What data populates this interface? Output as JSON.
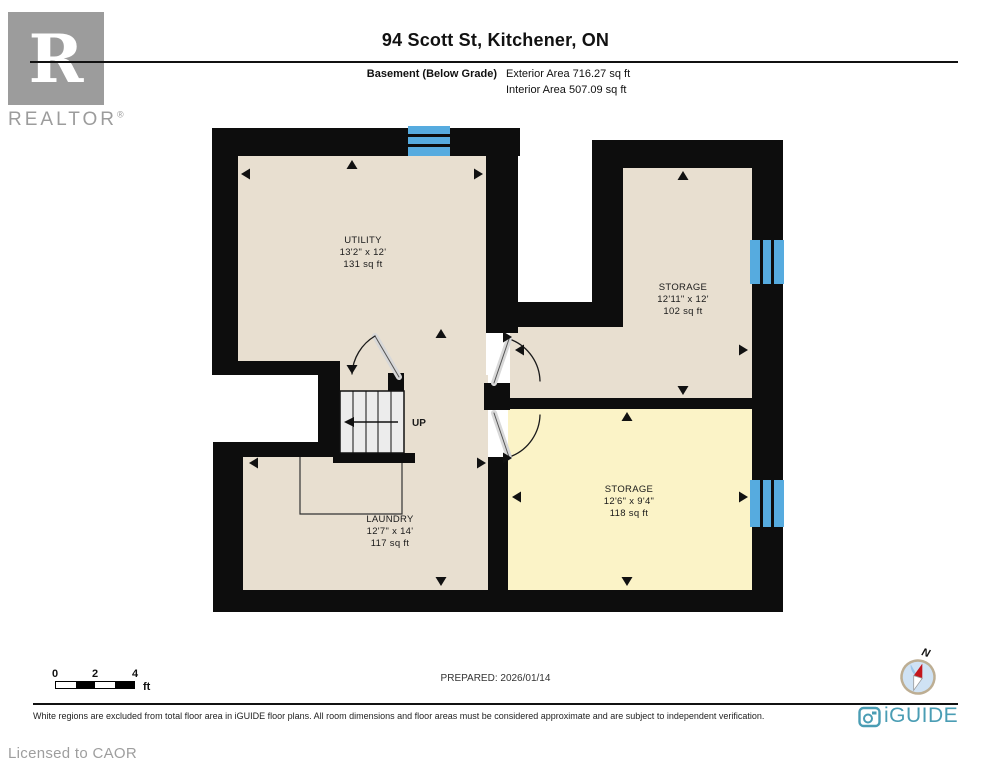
{
  "header": {
    "title": "94 Scott St, Kitchener, ON",
    "floor_label": "Basement (Below Grade)",
    "exterior_area": "Exterior Area 716.27 sq ft",
    "interior_area": "Interior Area 507.09 sq ft"
  },
  "branding": {
    "realtor_letter": "R",
    "realtor_text": "REALTOR",
    "registered": "®",
    "iguide_text": "iGUIDE",
    "licensed_text": "Licensed to CAOR"
  },
  "rooms": {
    "utility": {
      "name": "UTILITY",
      "dims": "13'2\" x 12'",
      "area": "131 sq ft"
    },
    "storage_upper": {
      "name": "STORAGE",
      "dims": "12'11\" x 12'",
      "area": "102 sq ft"
    },
    "storage_lower": {
      "name": "STORAGE",
      "dims": "12'6\" x 9'4\"",
      "area": "118 sq ft"
    },
    "laundry": {
      "name": "LAUNDRY",
      "dims": "12'7\" x 14'",
      "area": "117 sq ft"
    }
  },
  "stairs": {
    "label": "UP"
  },
  "scale_bar": {
    "t0": "0",
    "t2": "2",
    "t4": "4",
    "unit": "ft"
  },
  "footer": {
    "prepared": "PREPARED: 2026/01/14",
    "disclaimer": "White regions are excluded from total floor area in iGUIDE floor plans. All room dimensions and floor areas must be considered approximate and are subject to independent verification.",
    "compass_label": "N"
  },
  "colors": {
    "wall": "#0d0d0d",
    "room_beige": "#e8dfd0",
    "room_yellow": "#fbf3c7",
    "window_blue": "#56abdf",
    "stair_fill": "#ececec",
    "iguide_teal": "#4a9db4",
    "realtor_gray": "#9c9c9c",
    "compass_red": "#c4161c"
  }
}
